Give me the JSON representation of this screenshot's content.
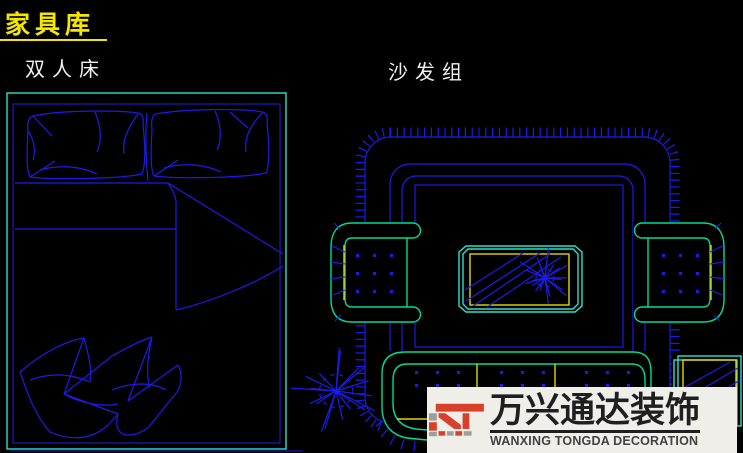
{
  "page": {
    "title": "家具库"
  },
  "items": {
    "bed_label": "双人床",
    "sofa_label": "沙发组"
  },
  "watermark": {
    "brand_cn": "万兴通达装饰",
    "brand_en": "WANXING TONGDA DECORATION"
  },
  "colors": {
    "background": "#000000",
    "title": "#F5E600",
    "labels": "#F0F0F0",
    "cad_blue": "#1C1CE8",
    "cad_navy": "#1A1AA8",
    "cad_teal": "#2EE0C8",
    "cad_green": "#00DC96",
    "cad_yellow": "#E3D600",
    "logo_red": "#D8402A",
    "logo_gray": "#9E9E9E",
    "logo_text_dark": "#1F1F1F",
    "logo_text_gray": "#424242",
    "watermark_bg": "#F0EEE9"
  }
}
